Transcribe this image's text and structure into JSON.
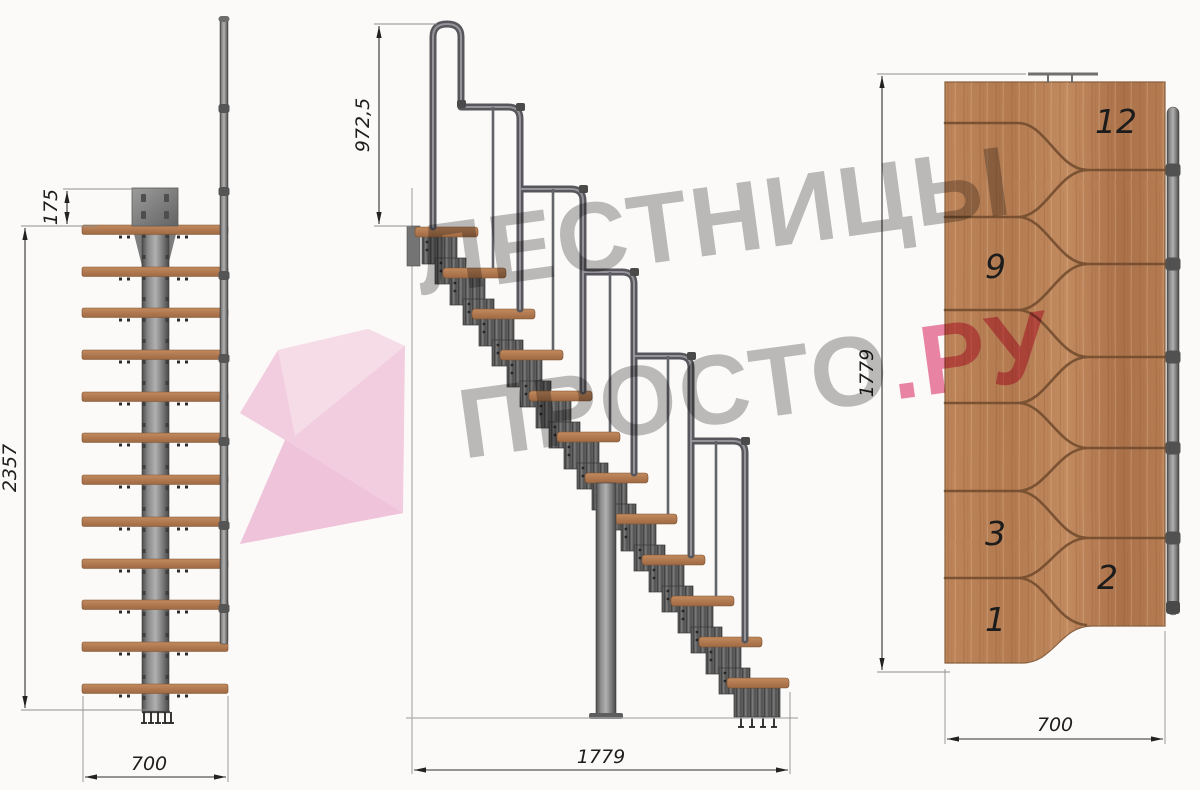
{
  "watermark": {
    "line1": "ЛЕСТНИЦЫ",
    "line2_main": "ПРОСТО",
    "line2_accent": ".РУ",
    "text_color": "#8c8c8c",
    "accent_color": "#e44d80",
    "logo_color": "#f3bedd"
  },
  "views": {
    "front": {
      "dims": {
        "plate_offset": "175",
        "total_height": "2357",
        "width": "700"
      }
    },
    "side": {
      "dims": {
        "railing_height": "972,5",
        "total_run": "1779"
      }
    },
    "plan": {
      "dims": {
        "total_run": "1779",
        "width": "700"
      },
      "tread_labels": [
        "12",
        "9",
        "3",
        "2",
        "1"
      ]
    }
  },
  "colors": {
    "background": "#fbfaf8",
    "wood": "#b47c55",
    "steel": "#757575",
    "dimension_line": "#2f2f2f"
  }
}
